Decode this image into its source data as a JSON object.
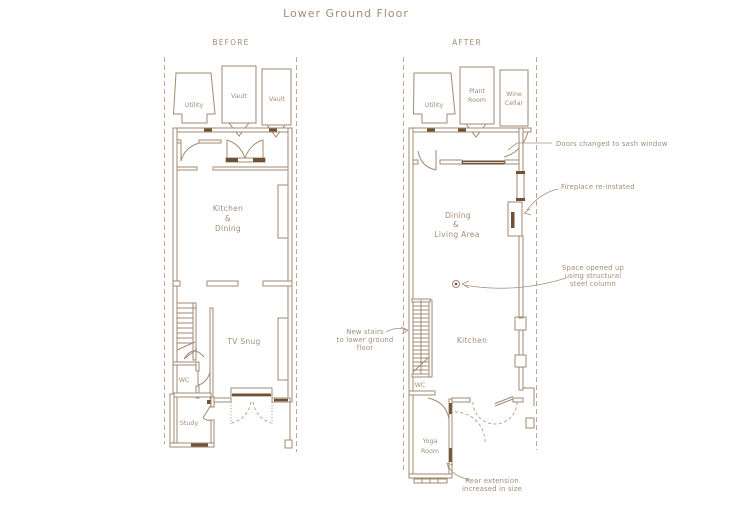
{
  "title": "Lower Ground Floor",
  "colors": {
    "line": "#a08a70",
    "dark_wall": "#6f5136",
    "text": "#a38d75",
    "background": "#ffffff"
  },
  "panels": {
    "before": {
      "label": "BEFORE",
      "rooms": {
        "utility": "Utility",
        "vault_1": "Vault",
        "vault_2": "Vault",
        "kitchen_dining": [
          "Kitchen",
          "&",
          "Dining"
        ],
        "tv_snug": "TV Snug",
        "wc": "WC",
        "study": "Study"
      }
    },
    "after": {
      "label": "AFTER",
      "rooms": {
        "utility": "Utility",
        "plant_room": [
          "Plant",
          "Room"
        ],
        "wine_cellar": [
          "Wine",
          "Cellar"
        ],
        "dining_living": [
          "Dining",
          "&",
          "Living Area"
        ],
        "kitchen": "Kitchen",
        "wc": "WC",
        "yoga_room": [
          "Yoga",
          "Room"
        ]
      },
      "annotations": {
        "sash_window": {
          "lines": [
            "Doors changed to sash window"
          ]
        },
        "fireplace": {
          "lines": [
            "Fireplace re-instated"
          ]
        },
        "steel_column": {
          "lines": [
            "Space opened up",
            "using structural",
            "steel column"
          ]
        },
        "new_stairs": {
          "lines": [
            "New stairs",
            "to lower ground",
            "floor"
          ]
        },
        "rear_extension": {
          "lines": [
            "Rear extension",
            "increased in size"
          ]
        }
      }
    }
  }
}
